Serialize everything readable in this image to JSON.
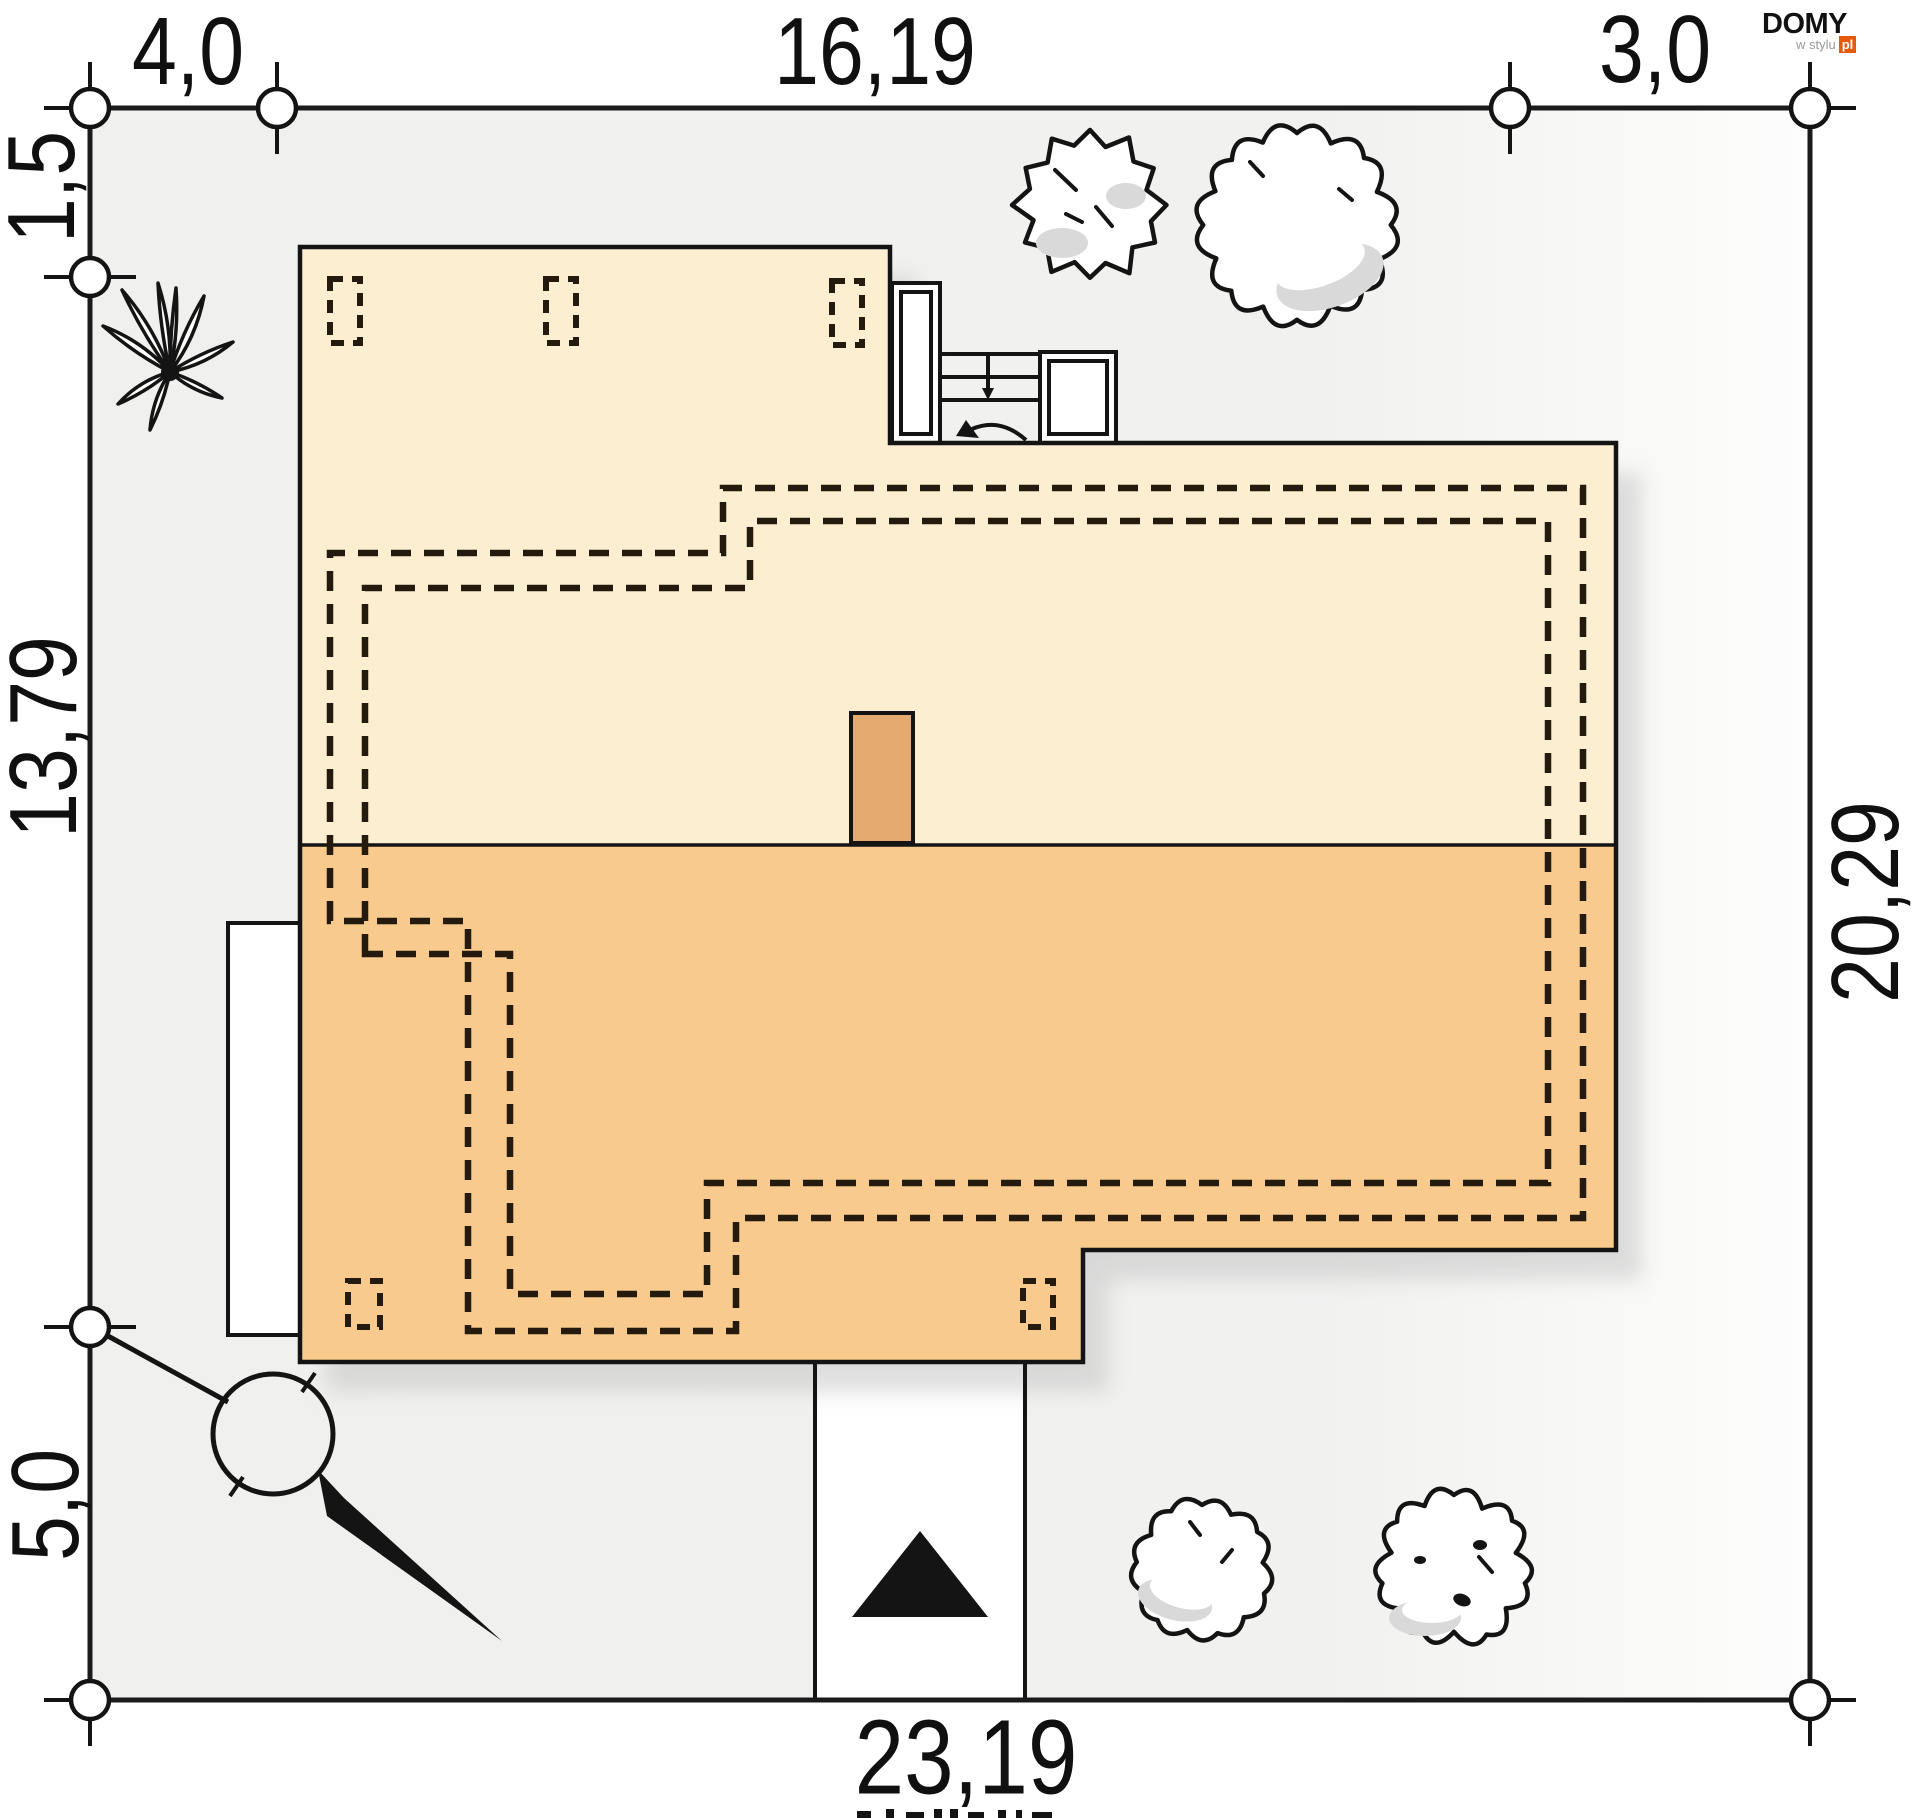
{
  "branding": {
    "name": "DOMY",
    "tagline": "w stylu",
    "tld": "pl"
  },
  "dimensions": {
    "top_left_offset": "4,0",
    "top_house_width": "16,19",
    "top_right_offset": "3,0",
    "left_top_offset": "1,5",
    "left_house_depth": "13,79",
    "left_bottom_offset": "5,0",
    "right_plot_depth": "20,29",
    "bottom_plot_width": "23,19"
  },
  "colors": {
    "plot_fill": "#f1f1ef",
    "plot_border": "#1b1b1b",
    "roof_upper": "#fbeed1",
    "roof_lower": "#f8ca8d",
    "chimney": "#e4aa70",
    "line": "#141414",
    "dash": "#241b0e",
    "tree_shade": "#d9d9d9",
    "shadow": "#c9c9c9",
    "logo_orange": "#e8590c"
  }
}
